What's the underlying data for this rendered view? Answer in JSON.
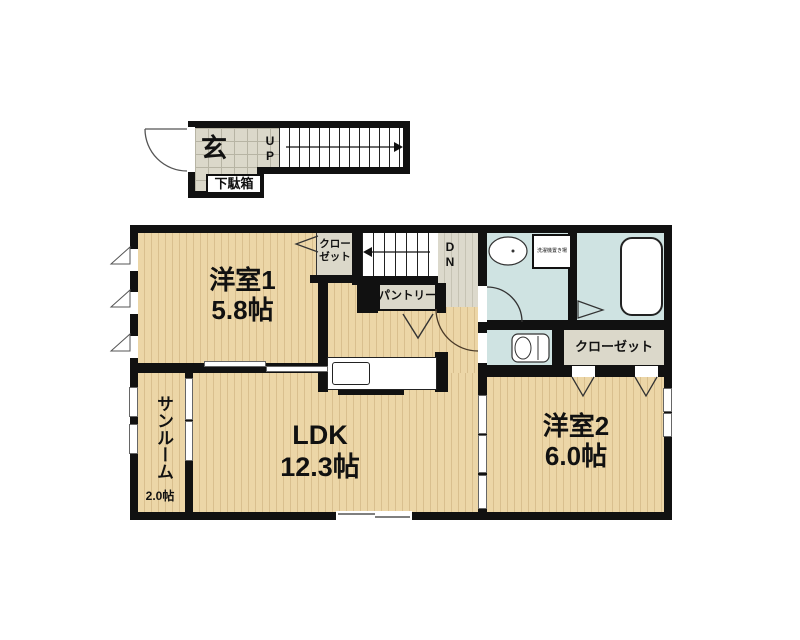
{
  "entrance": {
    "genkan_label": "玄",
    "stairs_up_label": "UP",
    "shoe_cabinet_label": "下駄箱"
  },
  "rooms": {
    "room1": {
      "name": "洋室1",
      "size": "5.8帖"
    },
    "room1_closet_label": "クローゼット",
    "stairs_down_label": "DN",
    "pantry_label": "パントリー",
    "washer_label": "洗濯機置き場",
    "closet2_label": "クローゼット",
    "room2": {
      "name": "洋室2",
      "size": "6.0帖"
    },
    "ldk": {
      "name": "LDK",
      "size": "12.3帖"
    },
    "sunroom": {
      "name": "サンルーム",
      "size": "2.0帖"
    }
  },
  "colors": {
    "wall": "#111111",
    "wood_floor": "#ecd6a7",
    "wood_stripe": "#d9bf8e",
    "tile_gray": "#dbd8ca",
    "hall_gray": "#dcd9cc",
    "wet_area_blue": "#cfe3e2",
    "fixture_white": "#ffffff"
  }
}
